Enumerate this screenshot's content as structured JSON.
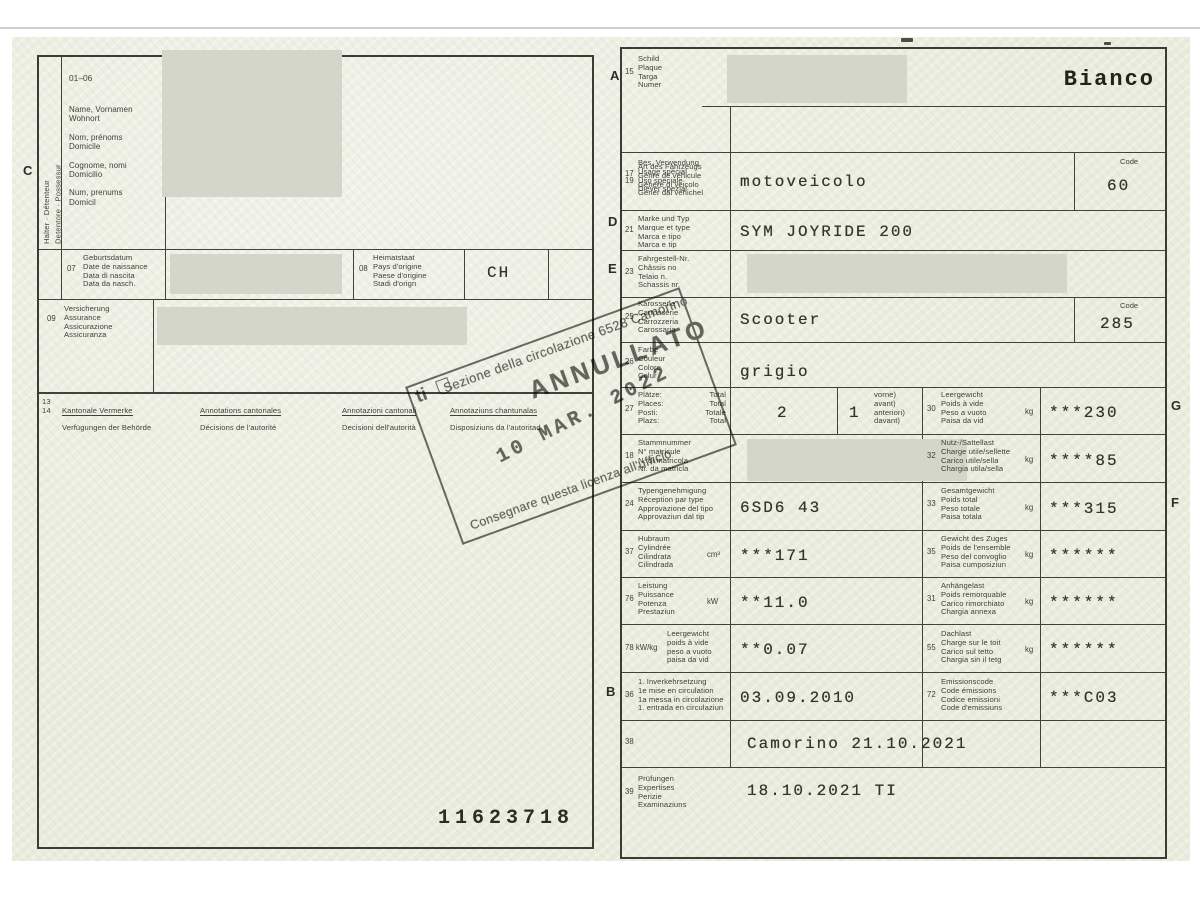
{
  "page_left": {
    "margin_letter": "C",
    "holder_vertical": "Halter · Détenteur\nDetentore · Possessur",
    "block_range": "01–06",
    "holder_labels": "Name, Vornamen\nWohnort\n\nNom, prénoms\nDomicile\n\nCognome, nomi\nDomicilio\n\nNum, prenums\nDomicil",
    "f07": {
      "num": "07",
      "labels": "Geburtsdatum\nDate de naissance\nData di nascita\nData da nasch."
    },
    "f08": {
      "num": "08",
      "labels": "Heimatstaat\nPays d'origine\nPaese d'origine\nStadi d'orign",
      "value": "CH"
    },
    "f09": {
      "num": "09",
      "labels": "Versicherung\nAssurance\nAssicurazione\nAssicuranza"
    },
    "f1314": {
      "nums": "13\n14",
      "c1a": "Kantonale Vermerke",
      "c1b": "Verfügungen der Behörde",
      "c2a": "Annotations cantonales",
      "c2b": "Décisions de l'autorité",
      "c3a": "Annotazioni cantonali",
      "c3b": "Decisioni dell'autorità",
      "c4a": "Annotaziuns chantunalas",
      "c4b": "Disposiziuns da l'autoritad"
    },
    "serial": "11623718"
  },
  "page_right": {
    "margin_letters": {
      "a": "A",
      "d": "D",
      "e": "E",
      "b": "B",
      "g": "G",
      "f": "F"
    },
    "code_label": "Code",
    "rows": {
      "r15": {
        "num": "15",
        "labels": "Schild\nPlaque\nTarga\nNumer",
        "right_value": "Bianco"
      },
      "r17": {
        "num": "17",
        "labels": "Bes. Verwendung\nUsage spécial\nUso speciale\nDiever spezial"
      },
      "r19": {
        "num": "19",
        "labels": "Art des Fahrzeugs\nGenre de véhicule\nGenere di veicolo\nGener dal vehichel",
        "value": "motoveicolo",
        "code": "60"
      },
      "r21": {
        "num": "21",
        "labels": "Marke und Typ\nMarque et type\nMarca e tipo\nMarca e tip",
        "value": "SYM JOYRIDE 200"
      },
      "r23": {
        "num": "23",
        "labels": "Fahrgestell-Nr.\nChâssis no\nTelaio n.\nSchassis nr."
      },
      "r25": {
        "num": "25",
        "labels": "Karosserie\nCarrosserie\nCarrozzeria\nCarossaria",
        "value": "Scooter",
        "code": "285"
      },
      "r26": {
        "num": "26",
        "labels": "Farbe\nCouleur\nColore\nColur",
        "value": "grigio"
      },
      "r27": {
        "num": "27",
        "labels": "Plätze:\nPlaces:\nPosti:\nPlazs:",
        "labels_total": "Total\nTotal\nTotale\nTotal",
        "value_total": "2",
        "value_front": "1",
        "front_note": "vorne)\navant)\nanteriori)\ndavant)"
      },
      "r30": {
        "num": "30",
        "labels": "Leergewicht\nPoids à vide\nPeso a vuoto\nPaisa da vid",
        "unit": "kg",
        "value": "***230"
      },
      "r18": {
        "num": "18",
        "labels": "Stammnummer\nN° matricule\nN. di matricola\nNr. da matricla"
      },
      "r32": {
        "num": "32",
        "labels": "Nutz-/Sattellast\nCharge utile/sellette\nCarico utile/sella\nChargia utila/sella",
        "unit": "kg",
        "value": "****85"
      },
      "r24": {
        "num": "24",
        "labels": "Typengenehmigung\nRéception par type\nApprovazione del tipo\nApprovaziun dal tip",
        "value": "6SD6 43"
      },
      "r33": {
        "num": "33",
        "labels": "Gesamtgewicht\nPoids total\nPeso totale\nPaisa totala",
        "unit": "kg",
        "value": "***315"
      },
      "r37": {
        "num": "37",
        "labels": "Hubraum\nCylindrée\nCilindrata\nCilindrada",
        "unit": "cm³",
        "value": "***171"
      },
      "r35": {
        "num": "35",
        "labels": "Gewicht des Zuges\nPoids de l'ensemble\nPeso del convoglio\nPaisa cumposiziun",
        "unit": "kg",
        "value": "******"
      },
      "r76": {
        "num": "76",
        "labels": "Leistung\nPuissance\nPotenza\nPrestaziun",
        "unit": "kW",
        "value": "**11.0"
      },
      "r31": {
        "num": "31",
        "labels": "Anhängelast\nPoids remorquable\nCarico rimorchiato\nChargia annexa",
        "unit": "kg",
        "value": "******"
      },
      "r78": {
        "num": "78 kW/kg",
        "labels": "Leergewicht\npoids à vide\npeso a vuoto\npaisa da vid",
        "value": "**0.07"
      },
      "r55": {
        "num": "55",
        "labels": "Dachlast\nCharge sur le toit\nCarico sul tetto\nChargia sin il tetg",
        "unit": "kg",
        "value": "******"
      },
      "r36": {
        "num": "36",
        "labels": "1. Inverkehrsetzung\n1e mise en circulation\n1a messa in circolazione\n1. entrada en circulaziun",
        "value": "03.09.2010"
      },
      "r72": {
        "num": "72",
        "labels": "Emissionscode\nCode émissions\nCodice emissioni\nCode d'emissiuns",
        "value": "***C03"
      },
      "r38": {
        "num": "38",
        "value": "Camorino 21.10.2021"
      },
      "r39": {
        "num": "39",
        "labels": "Prüfungen\nExpertises\nPerizie\nExaminaziuns",
        "value": "18.10.2021 TI"
      }
    }
  },
  "stamp": {
    "logo": "ti",
    "office": "Sezione della circolazione 6528 Camorino",
    "annulled": "ANNULLATO",
    "date": "10 MAR. 2022",
    "note": "Consegnare questa licenza all'ufficio"
  },
  "colors": {
    "paper": "#e9ebdc",
    "ink": "#3f4037",
    "redaction": "#d4d6c9",
    "stamp": "#50554b"
  }
}
